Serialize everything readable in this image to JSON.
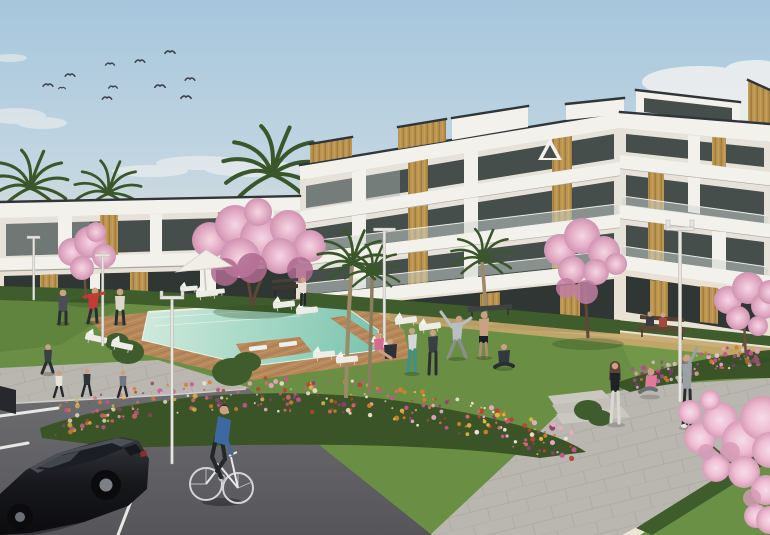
{
  "meta": {
    "alt_text": "Architectural 3D rendering of a modern white residential apartment complex with wood accents, communal lawn, turquoise swimming pool with wooden deck, pink blossom trees, palm trees, flower beds, people exercising, a cyclist and a parked black car"
  },
  "palette": {
    "sky_top": "#a6c6dd",
    "sky_mid": "#cdddE6",
    "sky_horizon": "#e9e1d3",
    "cloud": "#f7f5f1",
    "building_white": "#f3f1eb",
    "building_shadow": "#e7e2d9",
    "roof_edge": "#30353a",
    "glass_dark": "#454e4a",
    "glass_ground": "#2f3633",
    "glass_reflection": "#aeb9b4",
    "wood": "#b9934f",
    "wood_grain": "#97743a",
    "balustrade": "#ccd3d0",
    "lawn": "#6a8f44",
    "lawn_shadow": "#4d6e33",
    "flower_bed_base": "#3a5427",
    "hedge": "#3e5c2c",
    "palm_frond": "#3a572b",
    "palm_trunk": "#9a8a68",
    "blossom_pink": "#e4aec6",
    "blossom_light": "#f0c8d8",
    "blossom_deep": "#c07fa2",
    "branch_brown": "#6a4a3c",
    "pool_shallow": "#cde9db",
    "pool_water": "#9bd3c0",
    "pool_deep": "#72c0ab",
    "deck_wood": "#b5875a",
    "path_concrete": "#bab7b1",
    "tan_path": "#c6a86d",
    "asphalt": "#636367",
    "road_line": "#e8e8e6",
    "car_black": "#141418",
    "car_rim": "#7d8187",
    "skin": "#caa183",
    "accent_red": "#c23b35",
    "accent_teal": "#3f8f8a",
    "accent_pink": "#e07a9a",
    "accent_blue": "#3c69a0",
    "lamp_white": "#e6e5e1",
    "umbrella_white": "#f1eee7"
  },
  "scene": {
    "birds": [
      [
        48,
        85
      ],
      [
        62,
        88
      ],
      [
        70,
        75
      ],
      [
        110,
        64
      ],
      [
        140,
        61
      ],
      [
        113,
        87
      ],
      [
        160,
        86
      ],
      [
        170,
        52
      ],
      [
        190,
        79
      ],
      [
        186,
        97
      ],
      [
        107,
        98
      ]
    ],
    "flower_beds": [
      {
        "id": "bed-main",
        "pts": [
          [
            62,
            420
          ],
          [
            150,
            400
          ],
          [
            260,
            394
          ],
          [
            360,
            398
          ],
          [
            470,
            418
          ],
          [
            575,
            448
          ]
        ],
        "spread": 17,
        "count": 300,
        "colors": [
          "#d4802a",
          "#c9538e",
          "#eaa9c6",
          "#b8452f",
          "#efe3cf",
          "#e0b83e",
          "#8e3f74",
          "#d9667a"
        ]
      },
      {
        "id": "bed-right",
        "pts": [
          [
            618,
            382
          ],
          [
            700,
            364
          ],
          [
            766,
            352
          ]
        ],
        "spread": 12,
        "count": 110,
        "colors": [
          "#c9538e",
          "#a84a9a",
          "#e8a0c0",
          "#7c3b68",
          "#d4802a",
          "#e3c1d6"
        ]
      }
    ]
  }
}
